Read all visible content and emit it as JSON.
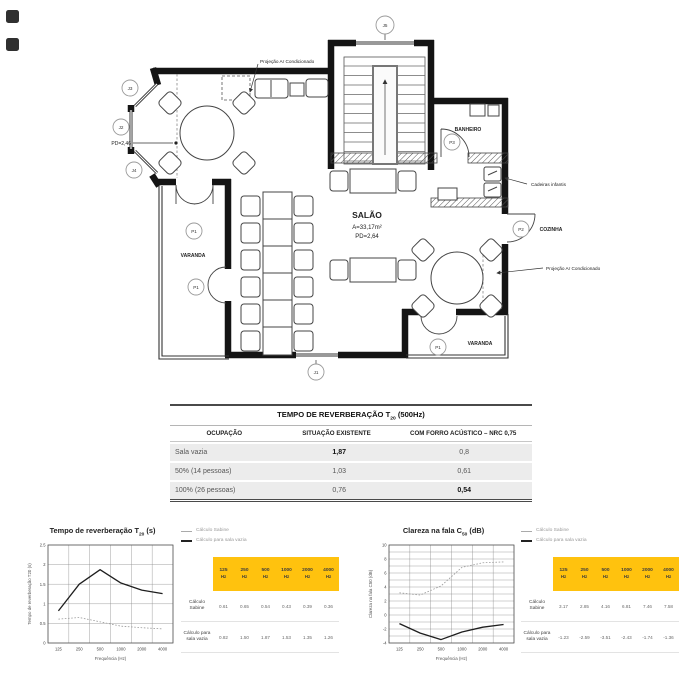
{
  "plan": {
    "salon": {
      "name": "SALÃO",
      "area": "A=33,17m²",
      "ceiling": "PD=2,64"
    },
    "labels": {
      "ac_projection_top": "Projeção Ar Condicionado",
      "ac_projection_right": "Projeção Ar Condicionado",
      "bathroom": "BANHEIRO",
      "kitchen": "COZINHA",
      "veranda_left": "VARANDA",
      "veranda_right": "VARANDA",
      "child_chairs": "Cadeiras infantis",
      "bay_ceiling": "PD=2,46"
    },
    "tags": {
      "j1": "J1",
      "j2": "J2",
      "j3": "J3",
      "j4": "J4",
      "j5": "J5",
      "p1a": "P1",
      "p1b": "P1",
      "p1c": "P1",
      "p2": "P2",
      "p3": "P3"
    }
  },
  "summary_table": {
    "title_pre": "TEMPO DE REVERBERAÇÃO T",
    "title_sub": "20",
    "title_post": " (500Hz)",
    "columns": [
      "OCUPAÇÃO",
      "SITUAÇÃO EXISTENTE",
      "COM FORRO ACÚSTICO – NRC 0,75"
    ],
    "rows": [
      {
        "occupancy": "Sala vazia",
        "existing": "1,87",
        "with_ceiling": "0,8"
      },
      {
        "occupancy": "50% (14 pessoas)",
        "existing": "1,03",
        "with_ceiling": "0,61"
      },
      {
        "occupancy": "100% (26 pessoas)",
        "existing": "0,76",
        "with_ceiling": "0,54"
      }
    ]
  },
  "chart_data": [
    {
      "type": "line",
      "title": "Tempo de reverberação T20 (s)",
      "title_parts": {
        "pre": "Tempo de reverberação T",
        "sub": "20",
        "post": " (s)"
      },
      "x": [
        125,
        250,
        500,
        1000,
        2000,
        4000
      ],
      "xlabel": "Frequência (Hz)",
      "ylabel": "Tempo de reverberação T20 (s)",
      "ylim": [
        0,
        2.5
      ],
      "yticks": [
        0,
        0.5,
        1,
        1.5,
        2,
        2.5
      ],
      "ygrid_step": 0.5,
      "grid": true,
      "legend_position": "outside-top-right",
      "series": [
        {
          "name": "Cálculo Sabine",
          "line": "dotted",
          "values": [
            0.61,
            0.65,
            0.54,
            0.43,
            0.39,
            0.36
          ]
        },
        {
          "name": "Cálculo para sala vazia",
          "line": "solid",
          "values": [
            0.82,
            1.5,
            1.87,
            1.53,
            1.35,
            1.26
          ]
        }
      ]
    },
    {
      "type": "line",
      "title": "Clareza na fala C50 (dB)",
      "title_parts": {
        "pre": "Clareza na fala C",
        "sub": "50",
        "post": " (dB)"
      },
      "x": [
        125,
        250,
        500,
        1000,
        2000,
        4000
      ],
      "xlabel": "Frequência (Hz)",
      "ylabel": "Clareza na fala C50 (dB)",
      "ylim": [
        -4,
        10
      ],
      "yticks": [
        -4,
        -2,
        0,
        2,
        4,
        6,
        8,
        10
      ],
      "ygrid_step": 1,
      "grid": true,
      "legend_position": "outside-top-right",
      "series": [
        {
          "name": "Cálculo Sabine",
          "line": "dotted",
          "values": [
            3.17,
            2.85,
            4.16,
            6.81,
            7.46,
            7.58
          ]
        },
        {
          "name": "Cálculo para sala vazia",
          "line": "solid",
          "values": [
            -1.23,
            -2.59,
            -3.51,
            -2.43,
            -1.74,
            -1.36
          ]
        }
      ]
    }
  ],
  "freq_unit": "Hz",
  "freq_header": [
    "125",
    "250",
    "500",
    "1000",
    "2000",
    "4000"
  ],
  "data_tables": [
    {
      "rows": [
        {
          "label": "Cálculo Sabine",
          "values": [
            "0.61",
            "0.65",
            "0.54",
            "0.43",
            "0.39",
            "0.36"
          ]
        },
        {
          "label": "Cálculo para sala vazia",
          "values": [
            "0.82",
            "1.50",
            "1.87",
            "1.53",
            "1.35",
            "1.26"
          ]
        }
      ]
    },
    {
      "rows": [
        {
          "label": "Cálculo Sabine",
          "values": [
            "3.17",
            "2.85",
            "4.16",
            "6.81",
            "7.46",
            "7.58"
          ]
        },
        {
          "label": "Cálculo para sala vazia",
          "values": [
            "-1.23",
            "-2.59",
            "-3.51",
            "-2.43",
            "-1.74",
            "-1.36"
          ]
        }
      ]
    }
  ],
  "colors": {
    "accent_yellow": "#FFC20E",
    "line_dark": "#1e1e1e",
    "line_gray": "#9a9a9a",
    "row_gray": "#ececec"
  }
}
